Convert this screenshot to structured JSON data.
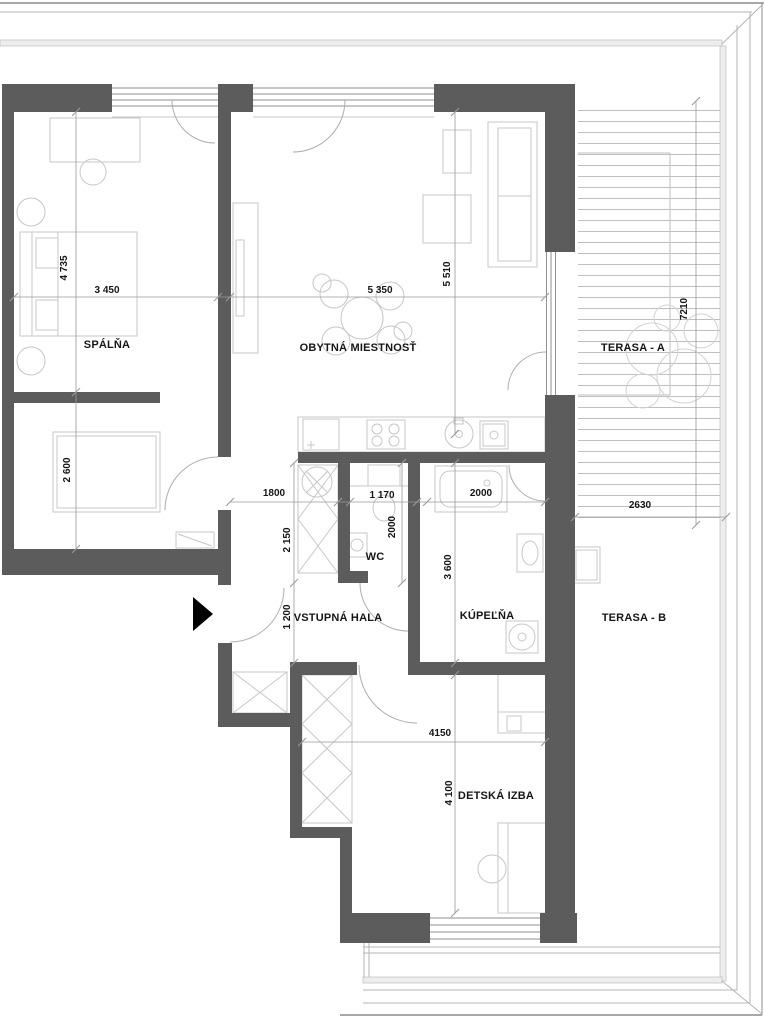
{
  "plan": {
    "type": "apartment-floor-plan",
    "rooms": {
      "bedroom": {
        "label": "SPÁLŇA"
      },
      "living": {
        "label": "OBYTNÁ MIESTNOSŤ"
      },
      "terrace_a": {
        "label": "TERASA - A"
      },
      "terrace_b": {
        "label": "TERASA - B"
      },
      "hall": {
        "label": "VSTUPNÁ HALA"
      },
      "wc": {
        "label": "WC"
      },
      "bathroom": {
        "label": "KÚPEĽŇA"
      },
      "kids_room": {
        "label": "DETSKÁ IZBA"
      }
    },
    "dimensions": {
      "bedroom_depth": "4 735",
      "bedroom_width": "3 450",
      "living_width": "5 350",
      "living_depth": "5 510",
      "terrace_a_length": "7210",
      "bedroom_closet_depth": "2 600",
      "hall_width": "1800",
      "wc_width": "1 170",
      "wc_depth": "2000",
      "bath_width": "2000",
      "bath_depth": "3 600",
      "hall_upper_depth": "2 150",
      "hall_lower_depth": "1 200",
      "terrace_b_width": "2630",
      "kids_width": "4150",
      "kids_depth": "4 100"
    },
    "colors": {
      "wall": "#5c5c5c",
      "furniture": "#c7c7c7",
      "plant": "#d2d2d2",
      "glazing": "#8f8f8f",
      "door": "#adadad",
      "dim": "#9a9a9a",
      "deck": "#bfbfbf",
      "frame": "#b5b5b5",
      "frameDark": "#8c8c8c",
      "frameFill": "#ededed",
      "arrow": "#000000",
      "text": "#161616"
    }
  }
}
